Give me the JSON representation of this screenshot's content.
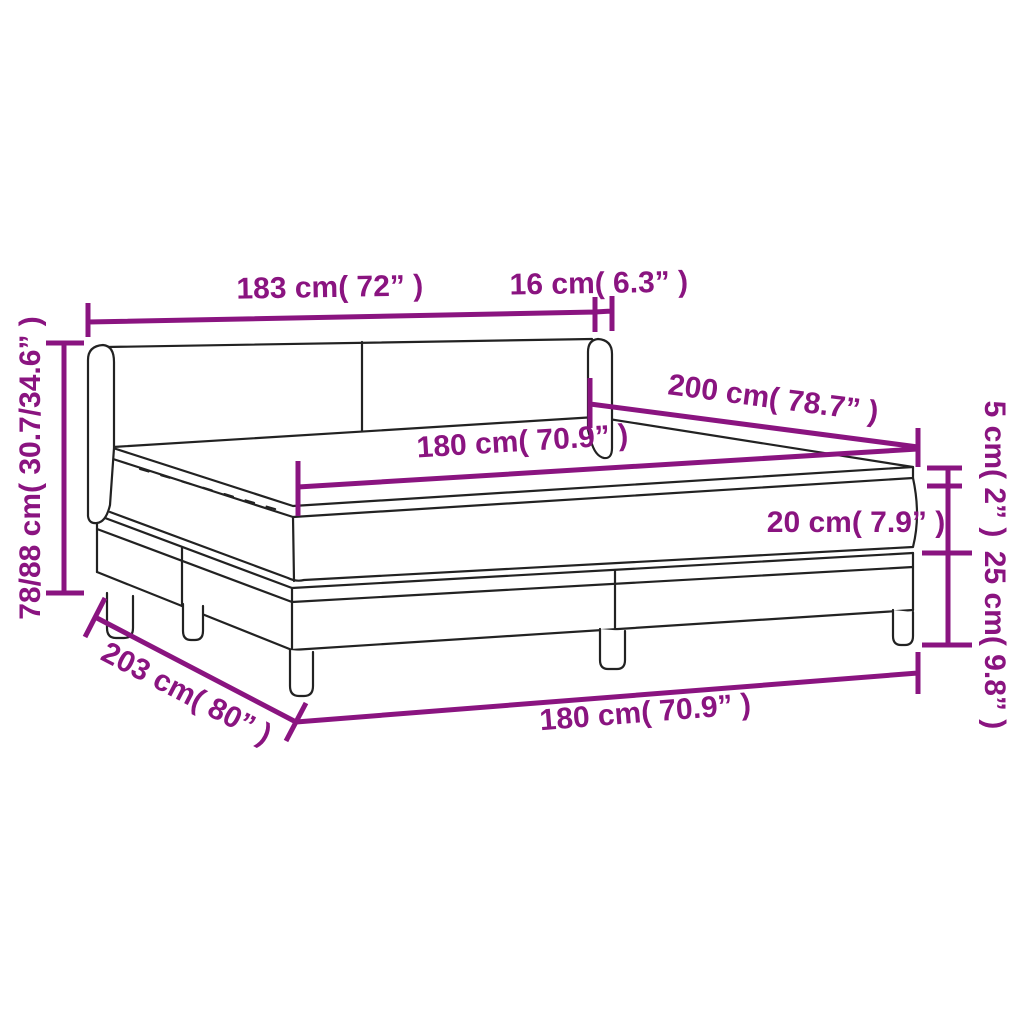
{
  "figure": {
    "type": "product-dimension-diagram",
    "subject": "box spring bed with headboard, mattress and topper",
    "background": "#FFFFFF"
  },
  "colors": {
    "dimension": "#8A1480",
    "outline": "#222222"
  },
  "dimensions": {
    "headboard_width": "183 cm( 72” )",
    "headboard_wing_depth": "16 cm( 6.3” )",
    "total_height_range": "78/88 cm( 30.7/34.6” )",
    "bed_length": "200 cm( 78.7” )",
    "mattress_width": "180 cm( 70.9” )",
    "topper_height": "5 cm( 2” )",
    "mattress_height": "20 cm( 7.9” )",
    "base_height": "25 cm( 9.8” )",
    "base_length": "203 cm( 80” )",
    "base_width": "180 cm( 70.9” )"
  }
}
